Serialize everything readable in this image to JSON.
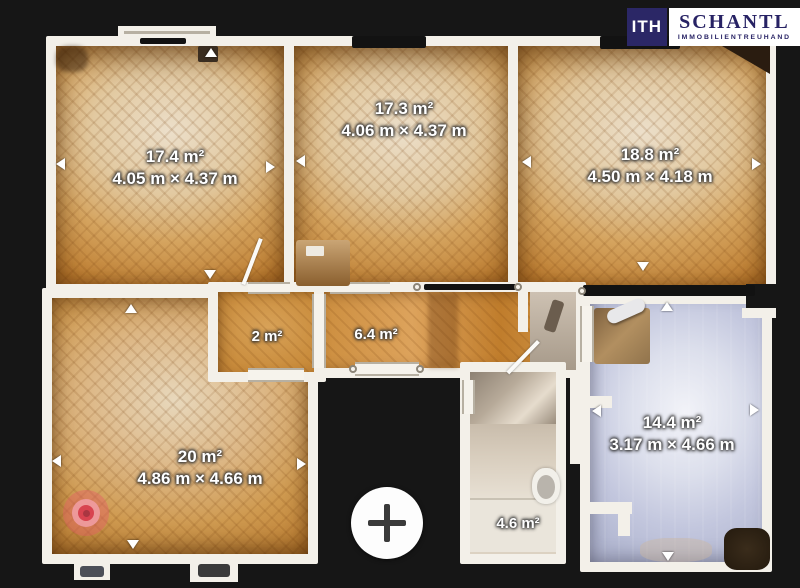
{
  "logo": {
    "monogram": "ITH",
    "brand": "SCHANTL",
    "subtitle": "IMMOBILIENTREUHAND"
  },
  "rooms": [
    {
      "id": "room-top-left",
      "area": "17.4 m²",
      "dimensions": "4.05 m × 4.37 m"
    },
    {
      "id": "room-top-middle",
      "area": "17.3 m²",
      "dimensions": "4.06 m × 4.37 m"
    },
    {
      "id": "room-top-right",
      "area": "18.8 m²",
      "dimensions": "4.50 m × 4.18 m"
    },
    {
      "id": "hallway-small",
      "area": "2 m²",
      "dimensions": ""
    },
    {
      "id": "corridor",
      "area": "6.4 m²",
      "dimensions": ""
    },
    {
      "id": "room-bottom-left",
      "area": "20 m²",
      "dimensions": "4.86 m × 4.66 m"
    },
    {
      "id": "bathroom",
      "area": "4.6 m²",
      "dimensions": ""
    },
    {
      "id": "room-bottom-right",
      "area": "14.4 m²",
      "dimensions": "3.17 m × 4.66 m"
    }
  ],
  "icons": {
    "zoom_in": "plus-icon",
    "position_marker": "camera-position-marker",
    "measure_arrow": "triangle-arrow-icon"
  },
  "colors": {
    "background": "#161616",
    "wall_white": "#f3f0e9",
    "parquet_orange": "#c2853a",
    "blue_floor": "#c3c7de",
    "brand_navy": "#2b2766",
    "marker_red": "#d84450"
  }
}
